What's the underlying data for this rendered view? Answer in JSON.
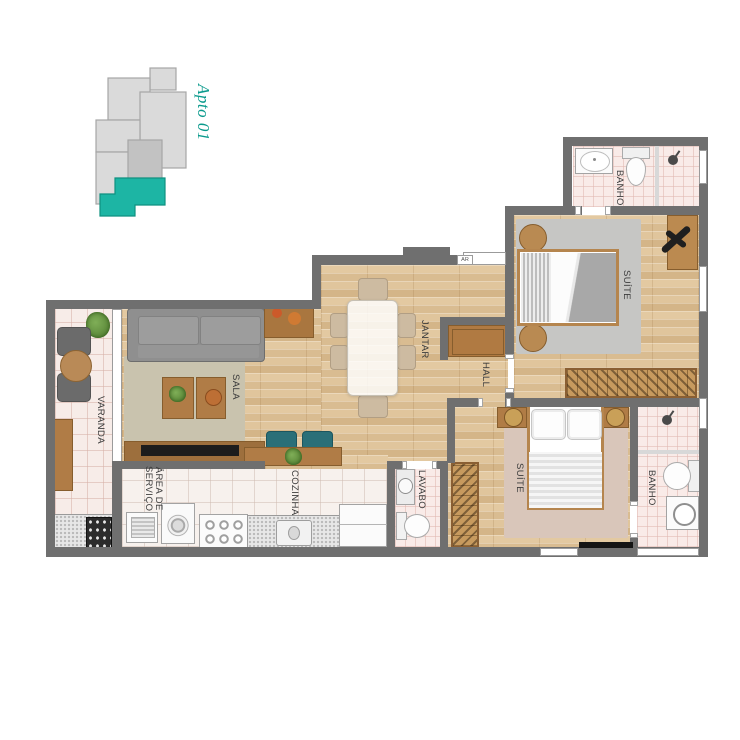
{
  "key_plan": {
    "unit_title": "Apto 01",
    "highlight_color": "#1db5a4",
    "title_color": "#0a9a8c"
  },
  "labels": {
    "varanda": "VARANDA",
    "sala": "SALA",
    "jantar": "JANTAR",
    "hall": "HALL",
    "cozinha": "COZINHA",
    "area_servico": "ÁREA DE\nSERVIÇO",
    "lavabo": "LAVABO",
    "suite_top": "SUÍTE",
    "suite_bottom": "SUÍTE",
    "banho_top": "BANHO",
    "banho_bottom": "BANHO",
    "ar": "AR"
  },
  "colors": {
    "wall": "#6f6f6f",
    "wood_floor": "#ddc29b",
    "tile_floor": "#f8edea",
    "bath_tile": "#f9ebe8",
    "accent_teal": "#1db5a4",
    "rug_sala": "#c9c3ae",
    "rug_suite_top": "#c6c6c4",
    "rug_suite_bottom": "#d9c6ba"
  },
  "icons": {
    "shower_top": "shower-head-icon",
    "shower_bottom": "shower-head-icon",
    "desk_chair": "office-chair-icon",
    "grill": "barbecue-grill-icon"
  }
}
